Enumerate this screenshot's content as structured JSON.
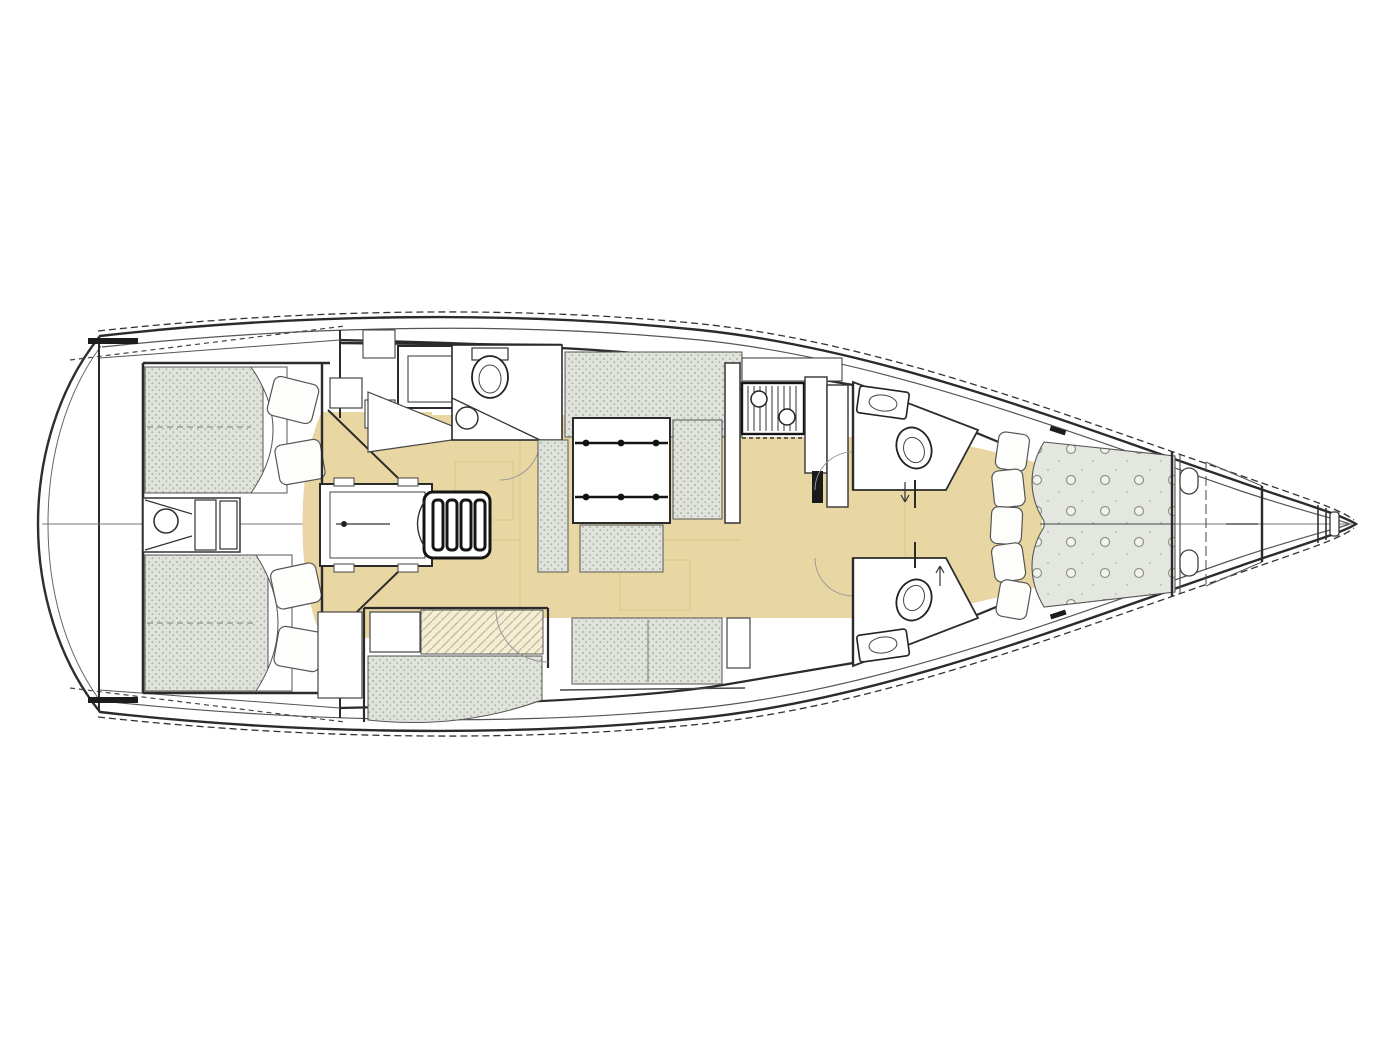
{
  "diagram": {
    "type": "floor-plan",
    "subject": "sailing-yacht-interior-deck-plan",
    "orientation": {
      "bow": "right",
      "stern": "left"
    },
    "palette": {
      "background": "#ffffff",
      "line": "#2b2b2b",
      "line_light": "#8f8f8f",
      "sole": "#e9d7a3",
      "sole_seam": "#d9c68f",
      "cushion_base": "#e0e3db",
      "cushion_dot": "#adb2a6",
      "hatch_base": "#f4eed6",
      "hatch_line": "#c6bd99",
      "mattress_base": "#e4e7df",
      "mattress_tuft": "#f1f3ec",
      "mattress_tuft_ring": "#8e948a",
      "white": "#ffffff",
      "dark": "#151515"
    },
    "areas": [
      {
        "id": "transom",
        "label": "transom-swim-platform"
      },
      {
        "id": "aft-cabin-stbd",
        "label": "aft-double-cabin-starboard"
      },
      {
        "id": "aft-cabin-port",
        "label": "aft-double-cabin-port"
      },
      {
        "id": "steering-compartment",
        "label": "steering-gear-compartment"
      },
      {
        "id": "engine-compartment",
        "label": "engine-compartment"
      },
      {
        "id": "companionway",
        "label": "companionway-steps"
      },
      {
        "id": "nav-station",
        "label": "navigation-station"
      },
      {
        "id": "aft-head",
        "label": "aft-head-with-toilet-and-sink"
      },
      {
        "id": "saloon",
        "label": "saloon-with-folding-table"
      },
      {
        "id": "saloon-settee-stbd",
        "label": "u-shaped-settee-starboard"
      },
      {
        "id": "saloon-settee-port",
        "label": "straight-settee-port"
      },
      {
        "id": "port-mid-cabin",
        "label": "port-midship-cabin-berth"
      },
      {
        "id": "galley",
        "label": "galley-with-stove-and-counters"
      },
      {
        "id": "fwd-head-stbd",
        "label": "forward-head-starboard"
      },
      {
        "id": "fwd-head-port",
        "label": "forward-head-port"
      },
      {
        "id": "owners-cabin",
        "label": "forward-owners-cabin-v-berth"
      },
      {
        "id": "bow-locker",
        "label": "bow-anchor-locker"
      }
    ]
  }
}
